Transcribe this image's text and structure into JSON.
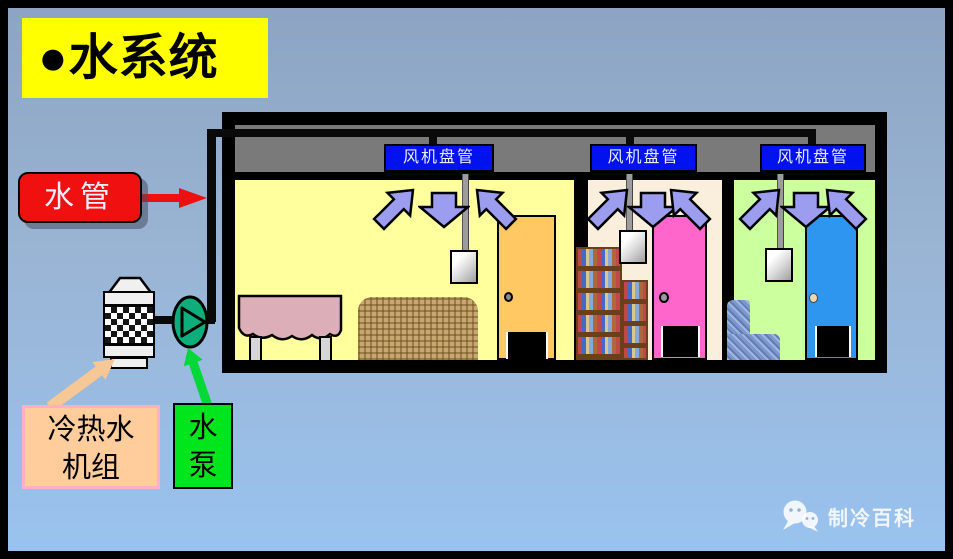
{
  "slide": {
    "title": "●水系统",
    "background_top": "#8CA4C2",
    "background_bottom": "#99C3EF"
  },
  "callouts": {
    "water_pipe": {
      "label": "水管",
      "bg": "#F01010",
      "arrow_color": "#EE1010"
    },
    "chiller": {
      "label_line1": "冷热水",
      "label_line2": "机组",
      "bg": "#FFCC9C",
      "border": "#FFAEC8",
      "arrow_color": "#F7C795"
    },
    "pump": {
      "label_line1": "水",
      "label_line2": "泵",
      "bg": "#00E51B",
      "arrow_color": "#00D83A"
    }
  },
  "building": {
    "fan_coil_units": [
      {
        "label": "风机盘管"
      },
      {
        "label": "风机盘管"
      },
      {
        "label": "风机盘管"
      }
    ],
    "fan_coil_label_bg": "#0013EF",
    "plenum_color": "#7A7A7A",
    "pipe_color": "#0A0A0A",
    "airflow_arrow_color": "#9D9DEF",
    "rooms": [
      {
        "name": "living-room",
        "wall_color": "#FFFF9E",
        "door_color": "#FFC862",
        "furniture": [
          "table",
          "woven-sofa"
        ]
      },
      {
        "name": "study-room",
        "wall_color": "#FAEFDC",
        "door_color": "#FF66CB",
        "furniture": [
          "bookshelves"
        ]
      },
      {
        "name": "bedroom",
        "wall_color": "#CCFF9E",
        "door_color": "#2F96F0",
        "furniture": [
          "armchair"
        ]
      }
    ]
  },
  "equipment": {
    "pump_color": "#0EAD7C"
  },
  "watermark": {
    "text": "制冷百科",
    "icon": "wechat-icon"
  }
}
